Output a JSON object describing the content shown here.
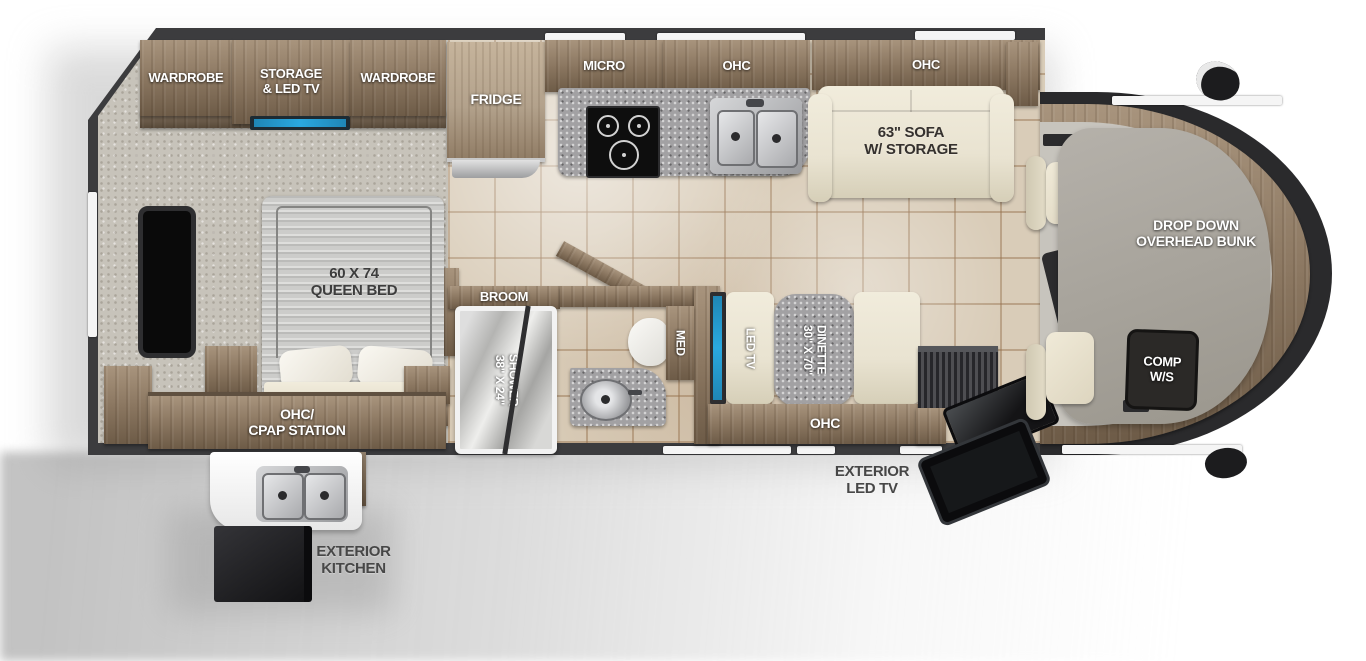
{
  "labels": {
    "wardrobe_rear": "WARDROBE",
    "storage_l1": "STORAGE",
    "storage_l2": "& LED TV",
    "wardrobe_front": "WARDROBE",
    "fridge": "FRIDGE",
    "micro": "MICRO",
    "kitchen_ohc": "OHC",
    "sofa_ohc": "OHC",
    "sofa_l1": "63\" SOFA",
    "sofa_l2": "W/ STORAGE",
    "bunk_l1": "DROP DOWN",
    "bunk_l2": "OVERHEAD BUNK",
    "comp_l1": "COMP",
    "comp_l2": "W/S",
    "bed_l1": "60 X 74",
    "bed_l2": "QUEEN BED",
    "cpap_l1": "OHC/",
    "cpap_l2": "CPAP STATION",
    "broom": "BROOM",
    "shower_l1": "38\" X 24\"",
    "shower_l2": "SHOWER",
    "med": "MED",
    "led_tv": "LED TV",
    "dinette_l1": "30\" X 70\"",
    "dinette_l2": "DINETTE",
    "dinette_ohc": "OHC",
    "ext_tv_l1": "EXTERIOR",
    "ext_tv_l2": "LED TV",
    "ext_kitchen_l1": "EXTERIOR",
    "ext_kitchen_l2": "KITCHEN"
  },
  "colors": {
    "body": "#3c3c3e",
    "wood": "#8a7660",
    "wood_light": "#b3a28c",
    "floor_tile": "#d9ccb8",
    "floor_bedroom": "#c7c3ba",
    "cream": "#e9e3d1",
    "granite": "#a2a1a3",
    "accent_blue": "#2aa9e0",
    "cab_floor": "#c7c4bd",
    "label_white": "#ffffff",
    "label_dark": "#3d3d3d"
  }
}
